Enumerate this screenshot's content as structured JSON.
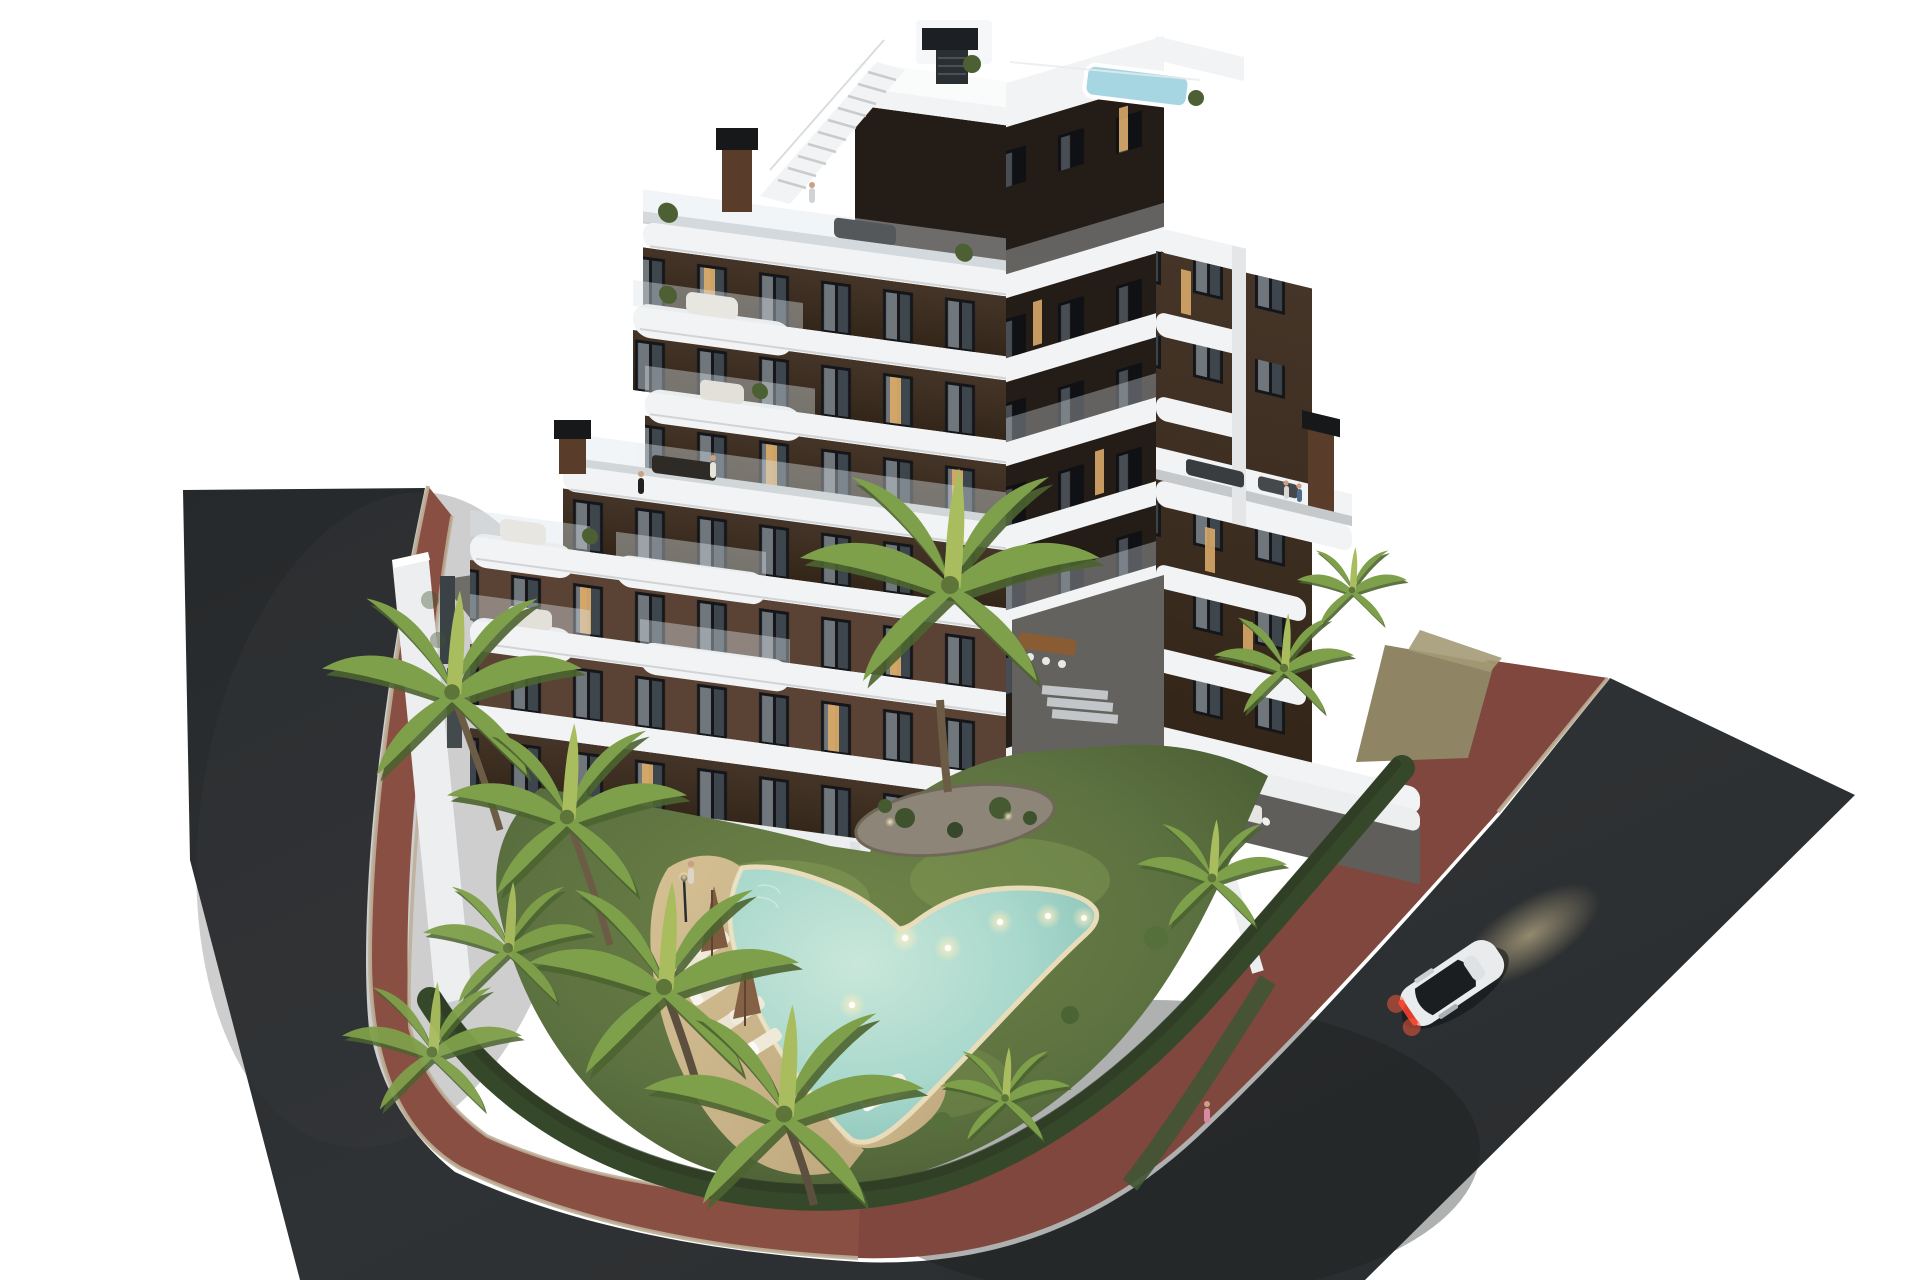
{
  "meta": {
    "title": "Aerial 3D architectural rendering of a modern apartment residence at dusk",
    "scene_type": "architectural visualization / real-estate render",
    "time_of_day": "dusk",
    "background_note": "isolated render on pure white background"
  },
  "building": {
    "style": "curved white balcony bands over dark brown facade",
    "floors_visible": 7,
    "features": [
      "stepped upper terraces",
      "rooftop terrace",
      "rooftop plunge pool",
      "external roof staircase",
      "white penthouse volume",
      "corten chimney stacks",
      "glass balustrades",
      "white balcony sofas",
      "potted plants",
      "lit windows"
    ]
  },
  "grounds": {
    "features": [
      "communal lawn garden",
      "free-form swimming pool with underwater lights",
      "tan sun deck",
      "sun loungers",
      "closed brown parasols",
      "planted rock island with tall palm",
      "trimmed hedges",
      "private walled ground-floor terraces",
      "outdoor dining sets",
      "path lamp"
    ]
  },
  "surroundings": {
    "left_road": "dark asphalt street",
    "right_road": "dark asphalt street",
    "sidewalk": "red brick paved path wrapping the plot corner",
    "vegetation": "palm tree cluster on the left, smaller palms on the right",
    "vehicle": {
      "type": "coupe",
      "color": "white",
      "state": "driving, tail lights and headlights on"
    }
  },
  "people": [
    "woman standing on pool deck",
    "person sunbathing on lounger",
    "couple on 4th-floor terrace",
    "person on rooftop terrace",
    "person walking on right lawn edge"
  ],
  "colors": {
    "background": "#ffffff",
    "asphalt": "#2d3032",
    "asphalt-dark": "#232628",
    "brick": "#8a4f43",
    "brick-dark": "#76423a",
    "curb": "#bcae97",
    "dirt": "#8f8565",
    "grass": "#5c7140",
    "grass-light": "#7f9551",
    "grass-dark": "#42552f",
    "hedge": "#36482a",
    "palm": "#7fa04a",
    "palm-light": "#a9bd5e",
    "palm-dark": "#4c6430",
    "trunk": "#6d5c45",
    "slab": "#f2f3f4",
    "slab-shade": "#d9dcde",
    "facade": "#3d2f25",
    "facade-warm": "#5a4334",
    "facade-shadow": "#241c16",
    "window-glass": "#16181c",
    "curtain": "#98a0a6",
    "lit-window": "#d8a968",
    "pool-water": "#a9d8cc",
    "pool-deep": "#84bfb4",
    "pool-rim": "#e9dcba",
    "deck": "#c9b289",
    "roof-pool": "#a7d6e3",
    "chimney": "#5a3c2a",
    "chimney-cap": "#17181a",
    "wall-white": "#eceeef",
    "terrace-floor": "#70706c",
    "car-body": "#e9ebed",
    "car-glass": "#1b1e20",
    "tail-light": "#e23a2b",
    "glow": "#f3e2b5"
  }
}
